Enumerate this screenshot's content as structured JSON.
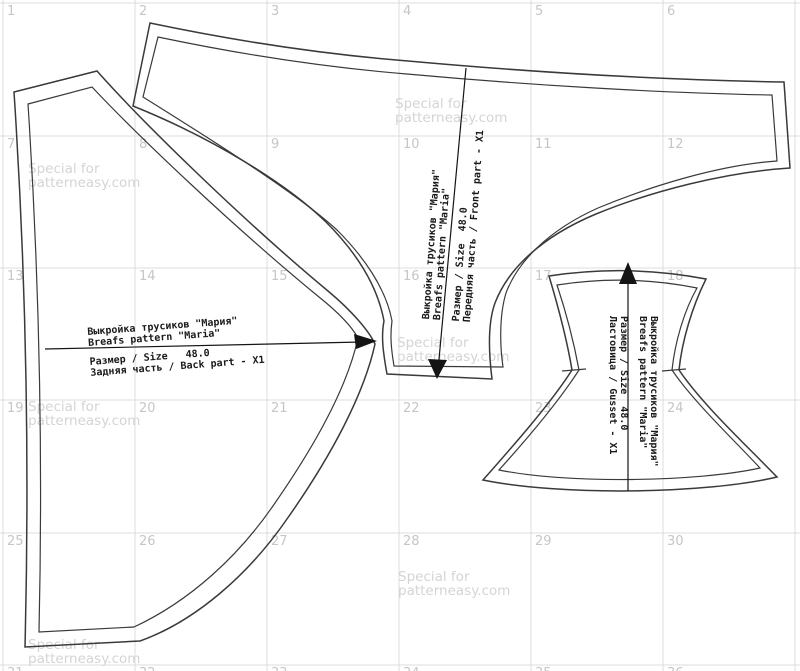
{
  "watermark": {
    "line1": "Special for",
    "line2": "patterneasy.com"
  },
  "grid": {
    "numbers": [
      [
        "1",
        "2",
        "3",
        "4",
        "5",
        "6"
      ],
      [
        "7",
        "8",
        "9",
        "10",
        "11",
        "12"
      ],
      [
        "13",
        "14",
        "15",
        "16",
        "17",
        "18"
      ],
      [
        "19",
        "20",
        "21",
        "22",
        "23",
        "24"
      ],
      [
        "25",
        "26",
        "27",
        "28",
        "29",
        "30"
      ],
      [
        "31",
        "32",
        "33",
        "34",
        "35",
        "36"
      ]
    ]
  },
  "pieces": {
    "back": {
      "id": "back-part",
      "lines": [
        "Выкройка трусиков \"Мария\"",
        "Breafs pattern \"Maria\"",
        "Размер / Size   48.0",
        "Задняя часть / Back part - X1"
      ]
    },
    "front": {
      "id": "front-part",
      "lines": [
        "Выкройка трусиков \"Мария\"",
        "Breafs pattern \"Maria\"",
        "Размер / Size  48.0",
        "Передняя часть / Front part - X1"
      ]
    },
    "gusset": {
      "id": "gusset",
      "lines": [
        "Выкройка трусиков \"Мария\"",
        "Breafs pattern \"Maria\"",
        "Размер / Size  48.0",
        "Ластовица / Gusset - X1"
      ]
    }
  },
  "colors": {
    "background": "#ffffff",
    "grid_line": "#dcdcdc",
    "grid_number": "#c6c6c6",
    "watermark": "#d4d4d4",
    "outline": "#3a3a3a",
    "arrow": "#141414",
    "label_text": "#1a1a1a"
  }
}
